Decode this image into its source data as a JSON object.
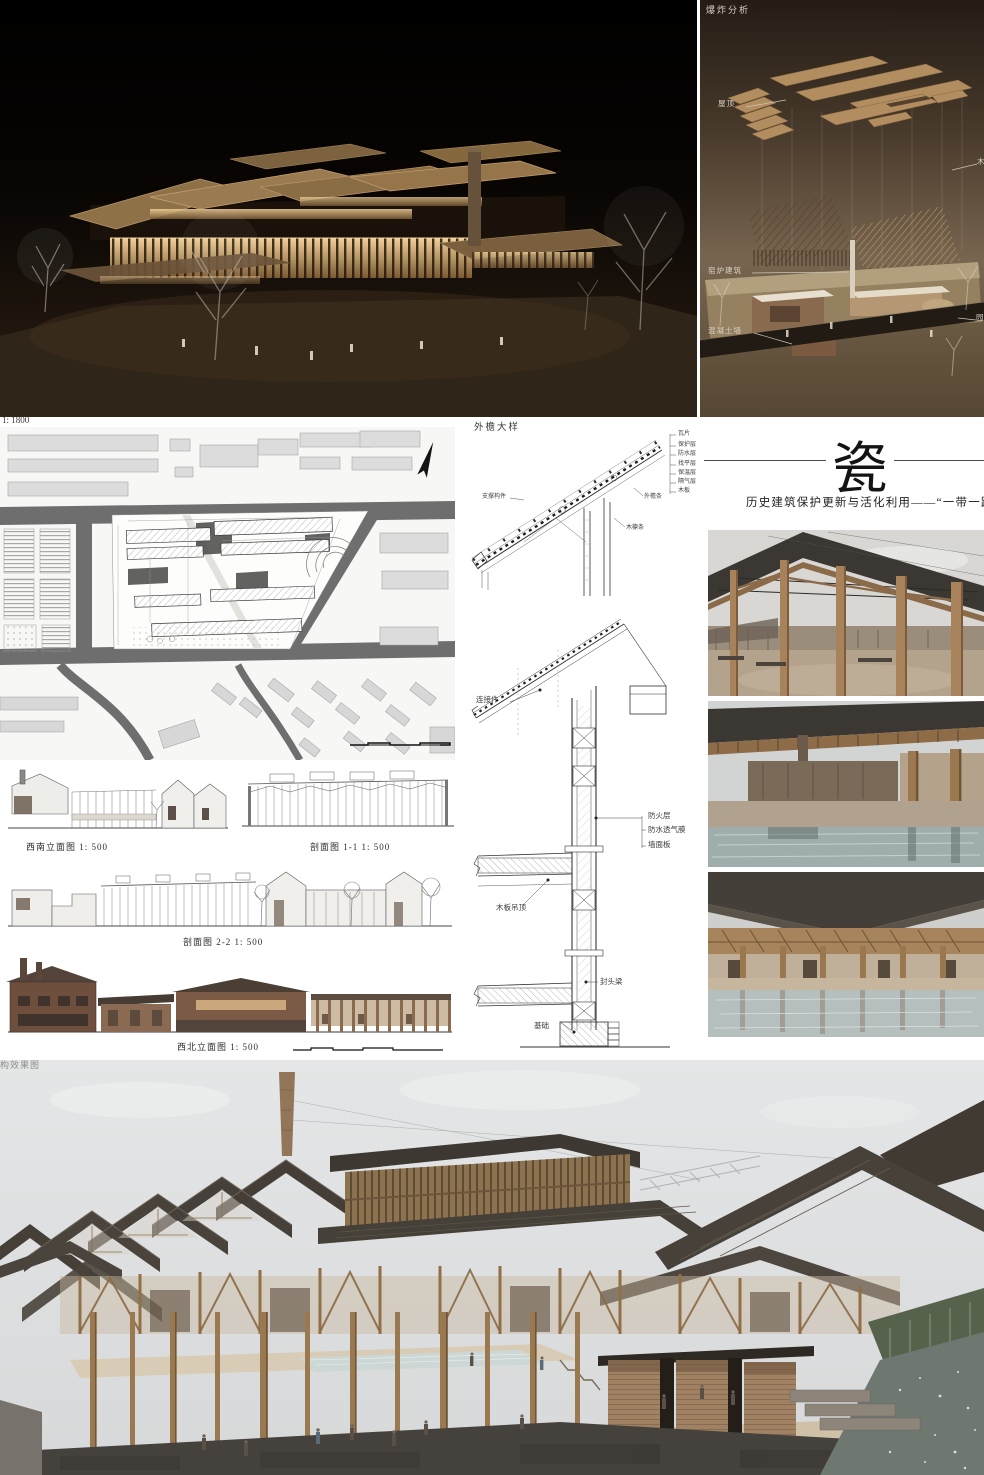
{
  "board": {
    "title_char": "瓷",
    "subtitle": "历史建筑保护更新与活化利用——“一带一路”博物",
    "bottom_render_label": "结构效果图",
    "plan_scale_label": "1: 1800"
  },
  "explosion_panel": {
    "title": "爆炸分析",
    "roof_label": "屋顶",
    "timber_label": "木",
    "kiln_label": "窑炉建筑",
    "concrete_label": "混凝土墙",
    "garden_label": "园"
  },
  "eave_detail": {
    "title": "外檐大样",
    "layers": [
      "瓦片",
      "保护层",
      "防水层",
      "找平层",
      "保温层",
      "隔气层",
      "木板"
    ],
    "support_label": "支撑构件",
    "eave_batten_label": "外檐条",
    "purlin_label": "木檩条"
  },
  "wall_section": {
    "connector_label": "连接件",
    "fire_label": "防火层",
    "membrane_label": "防水透气膜",
    "wall_panel_label": "墙面板",
    "ceiling_label": "木板吊顶",
    "head_beam_label": "封头梁",
    "foundation_label": "基础"
  },
  "drawing_titles": {
    "sw_elevation": "西南立面图  1: 500",
    "section_1_1": "剖面图 1-1  1: 500",
    "section_2_2": "剖面图 2-2  1: 500",
    "nw_elevation": "西北立面图  1: 500"
  },
  "colors": {
    "accent_wood": "#b18a5e",
    "roof_dark": "#45403a",
    "night_glow": "#e8c48a",
    "road_gray": "#6e6e6e"
  }
}
